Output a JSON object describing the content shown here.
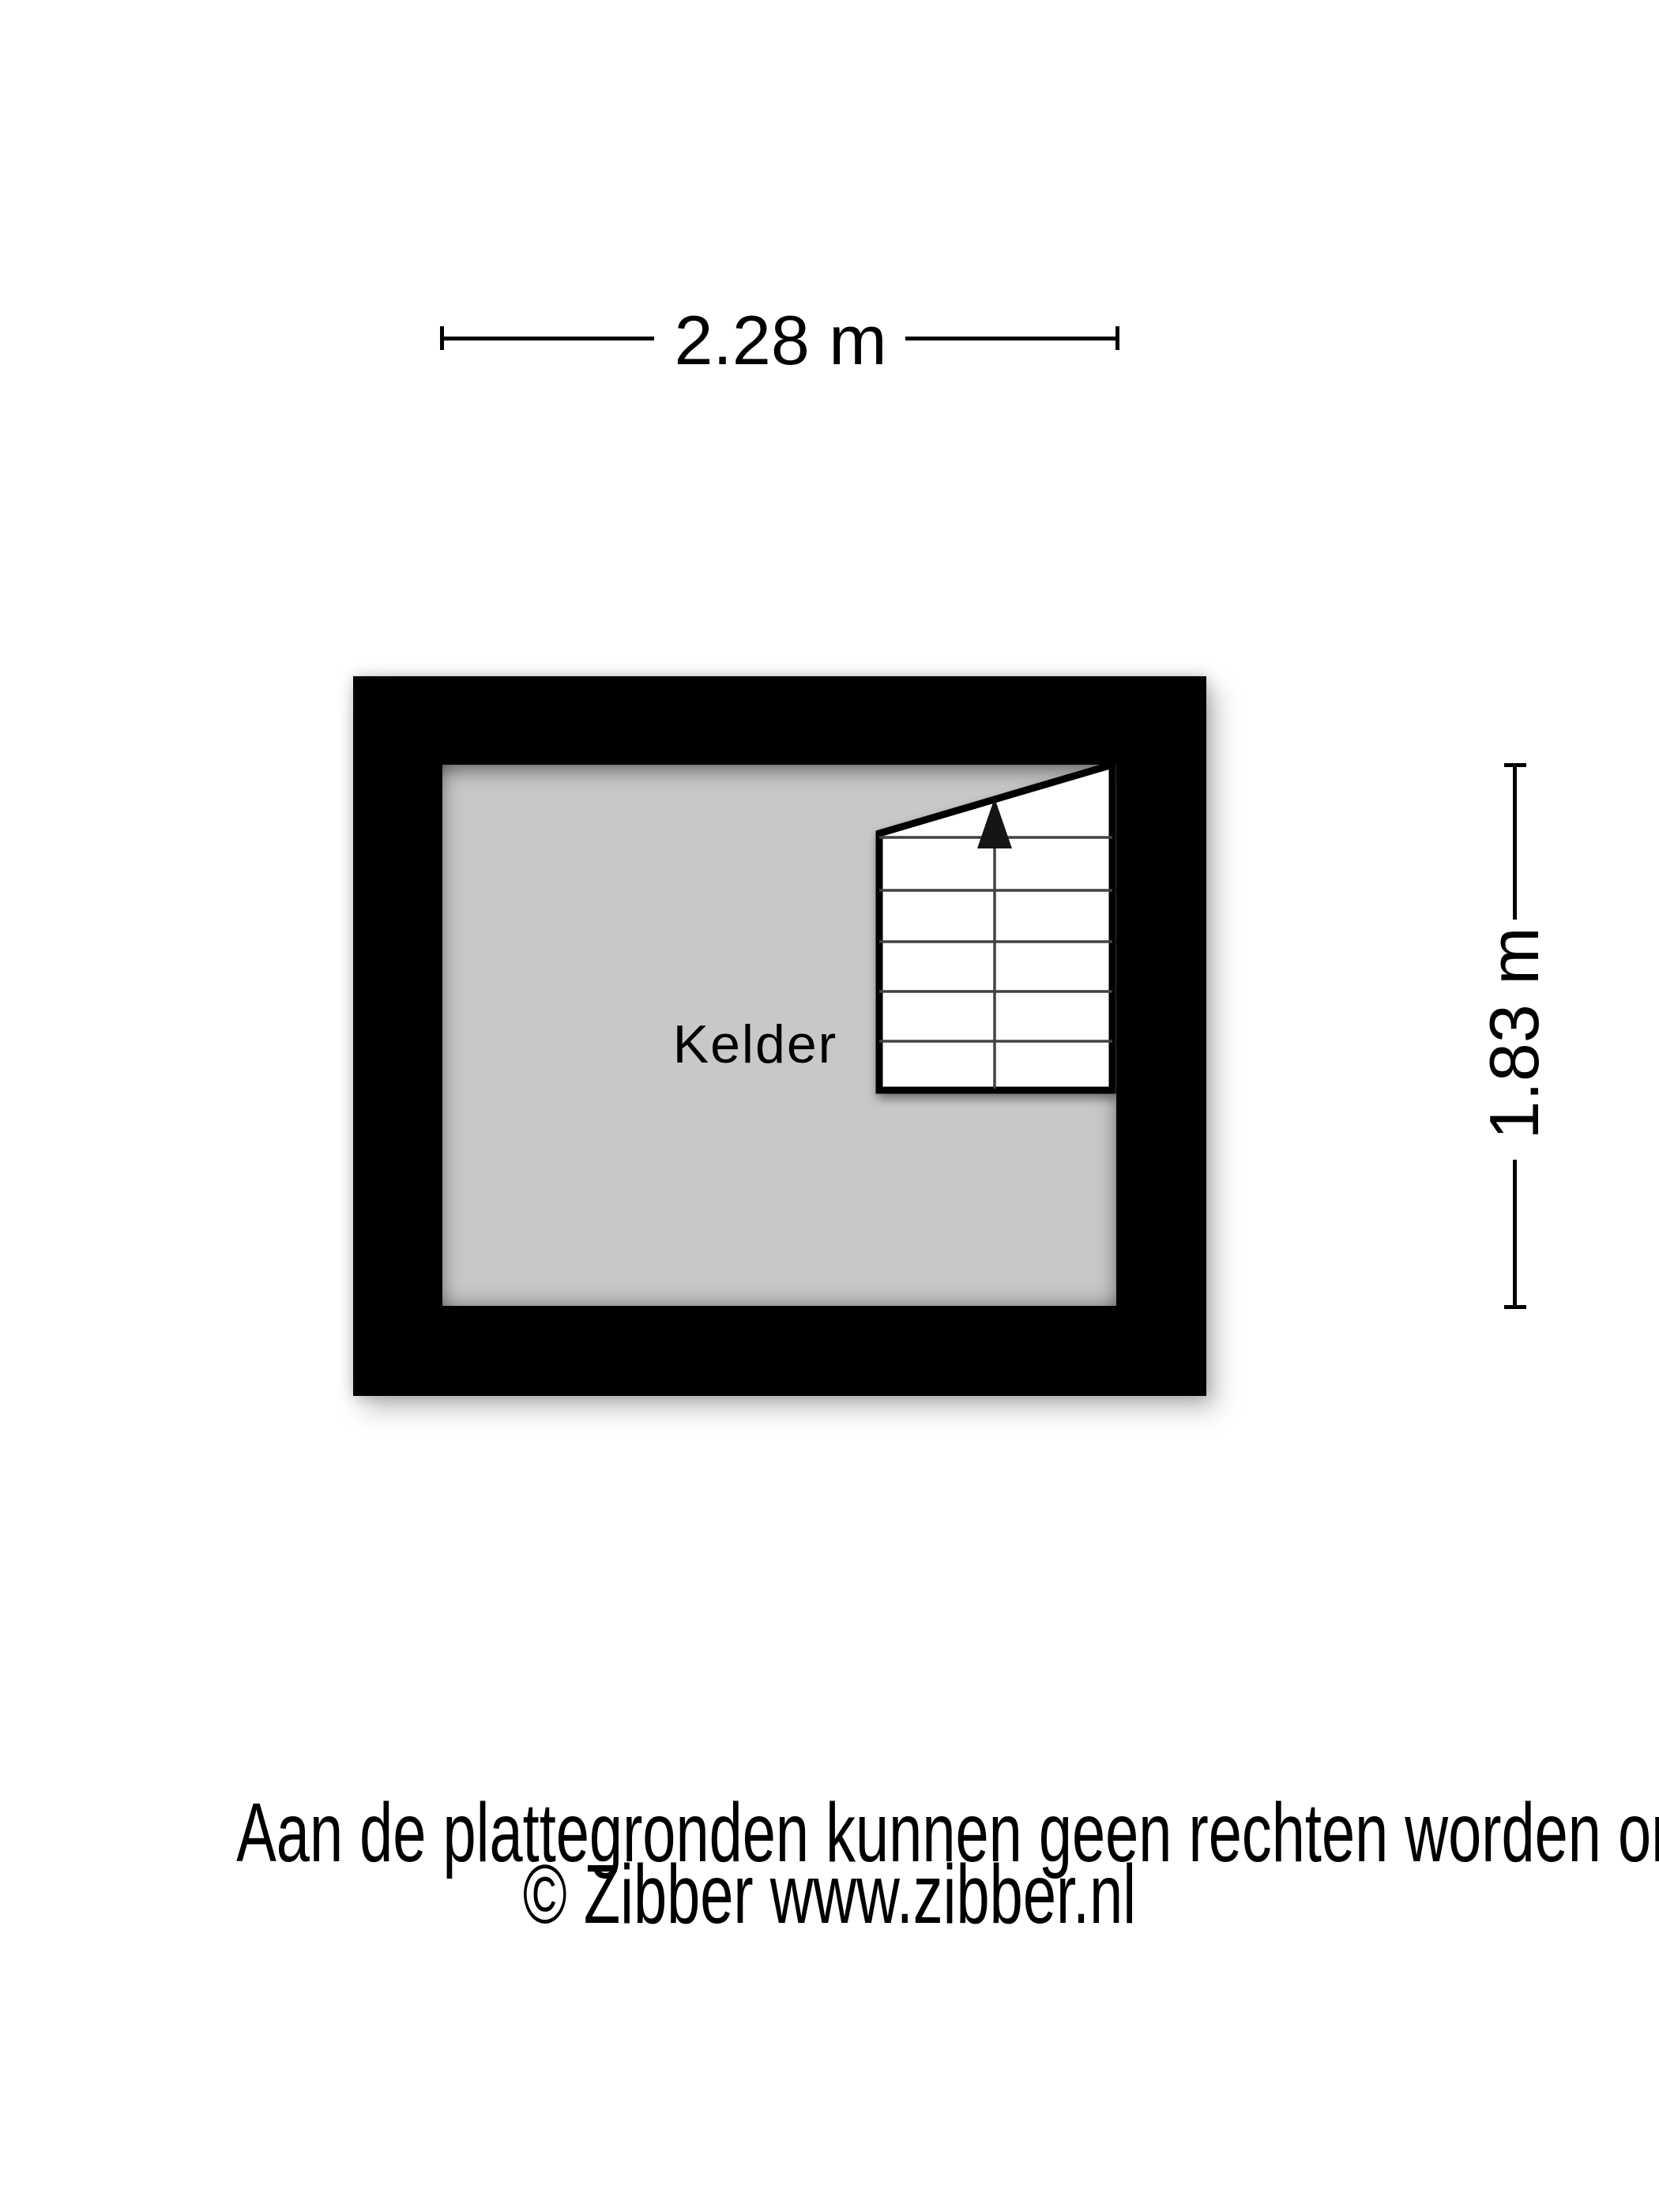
{
  "floor_plan": {
    "room_label": "Kelder",
    "stairs": {
      "steps": 6,
      "arrow_direction": "up"
    }
  },
  "dimensions": {
    "width": "2.28 m",
    "height": "1.83 m"
  },
  "footer": {
    "disclaimer": "Aan de plattegronden kunnen geen rechten worden ontleend",
    "copyright": "© Zibber www.zibber.nl"
  },
  "colors": {
    "background": "#ffffff",
    "wall": "#000000",
    "floor": "#c8c8c8",
    "stairs-fill": "#ffffff",
    "tread-line": "#424242",
    "dim-line": "#000000",
    "text": "#000000"
  }
}
